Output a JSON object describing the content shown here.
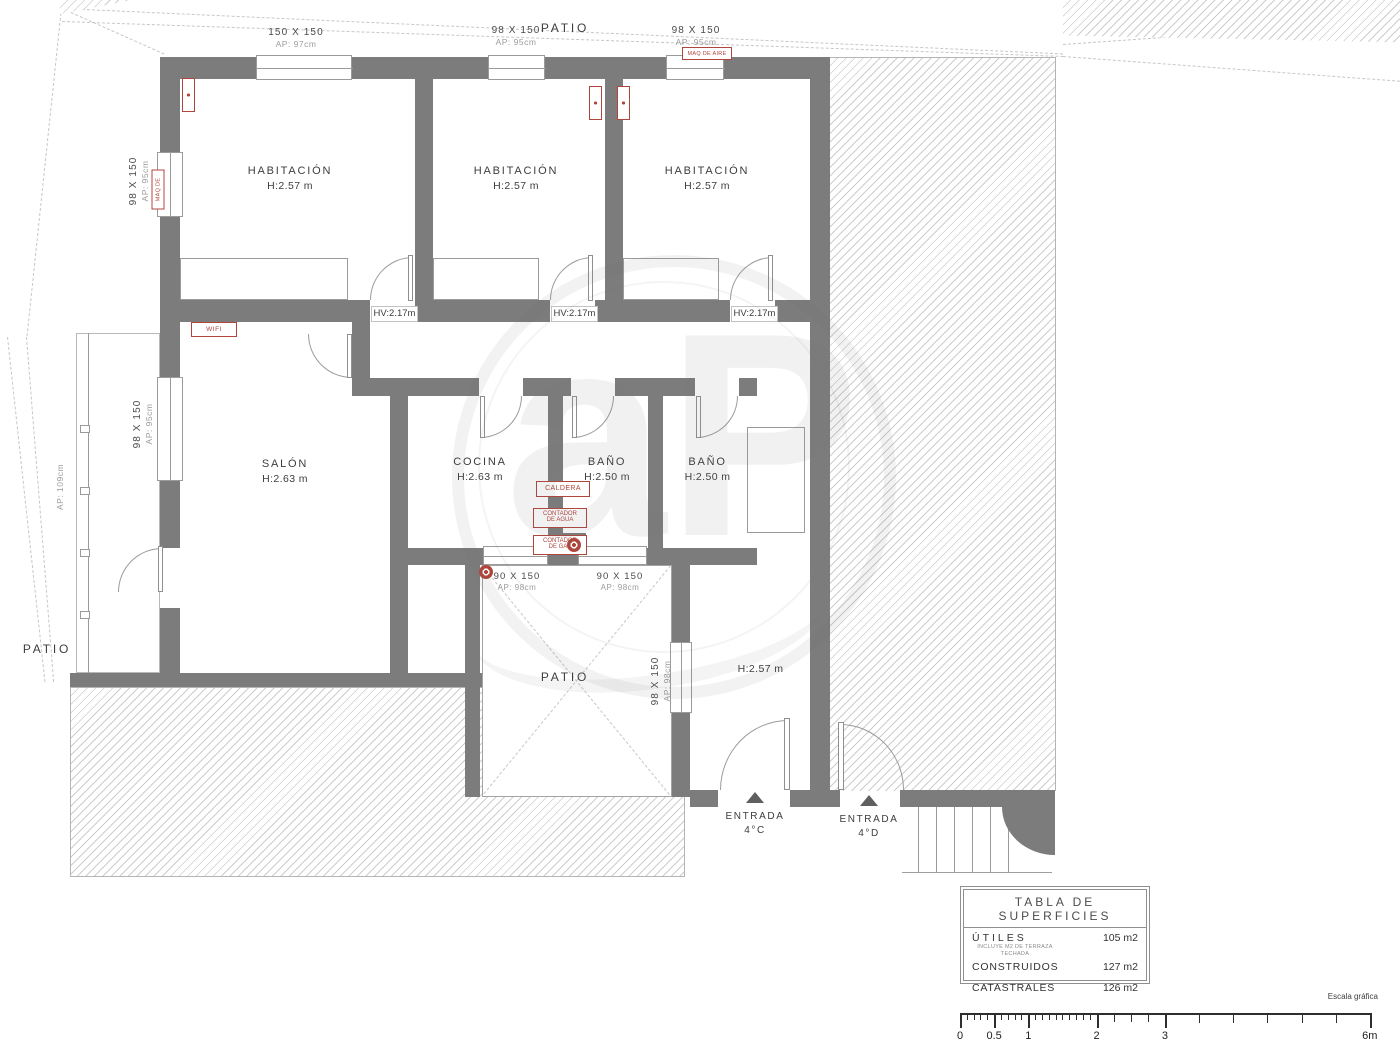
{
  "plan": {
    "watermark_text": "aP",
    "labels": {
      "patio_top": "PATIO",
      "patio_left": "PATIO",
      "patio_court": "PATIO",
      "hv": "HV:2.17m",
      "hall_h": "H:2.57 m"
    },
    "rooms": {
      "hab1_name": "HABITACIÓN",
      "hab1_h": "H:2.57 m",
      "hab2_name": "HABITACIÓN",
      "hab2_h": "H:2.57 m",
      "hab3_name": "HABITACIÓN",
      "hab3_h": "H:2.57 m",
      "salon_name": "SALÓN",
      "salon_h": "H:2.63 m",
      "cocina_name": "COCINA",
      "cocina_h": "H:2.63 m",
      "bano1_name": "BAÑO",
      "bano1_h": "H:2.50 m",
      "bano2_name": "BAÑO",
      "bano2_h": "H:2.50 m"
    },
    "windows": {
      "top1_size": "150 X 150",
      "top1_ap": "AP: 97cm",
      "top2_size": "98 X 150",
      "top2_ap": "AP: 95cm",
      "top3_size": "98 X 150",
      "top3_ap": "AP: 95cm",
      "left1_size": "98 X 150",
      "left1_ap": "AP: 95cm",
      "left2_size": "98 X 150",
      "left2_ap": "AP: 95cm",
      "terrace_ap": "AP: 109cm",
      "patio1_size": "90 X 150",
      "patio1_ap": "AP: 98cm",
      "patio2_size": "90 X 150",
      "patio2_ap": "AP: 98cm",
      "patio3_size": "98 X 150",
      "patio3_ap": "AP: 98cm"
    },
    "red": {
      "maq_top": "MAQ DE AIRE",
      "maq_left": "MAQ DE AIRE",
      "wifi": "WIFI",
      "caldera": "CALDERA",
      "cont_agua_1": "CONTADOR",
      "cont_agua_2": "DE AGUA",
      "cont_gas_1": "CONTADOR",
      "cont_gas_2": "DE GAS"
    },
    "entrances": {
      "c1": "ENTRADA",
      "c2": "4°C",
      "d1": "ENTRADA",
      "d2": "4°D"
    }
  },
  "table": {
    "title": "TABLA DE SUPERFICIES",
    "rows": [
      {
        "label": "ÚTILES",
        "note": "INCLUYE M2 DE TERRAZA TECHADA",
        "value": "105 m2"
      },
      {
        "label": "CONSTRUIDOS",
        "note": "",
        "value": "127 m2"
      },
      {
        "label": "CATASTRALES",
        "note": "",
        "value": "126 m2"
      }
    ]
  },
  "scalebar": {
    "title": "Escala gráfica",
    "unit_px_per_m": 68.3,
    "marks": [
      {
        "m": 0,
        "label": "0"
      },
      {
        "m": 0.5,
        "label": "0.5"
      },
      {
        "m": 1,
        "label": "1"
      },
      {
        "m": 2,
        "label": "2"
      },
      {
        "m": 3,
        "label": "3"
      },
      {
        "m": 6,
        "label": "6m"
      }
    ],
    "minor_segments": [
      {
        "from": 0,
        "to": 2,
        "step": 0.1,
        "h": 7
      },
      {
        "from": 2,
        "to": 3,
        "step": 0.25,
        "h": 9
      },
      {
        "from": 3,
        "to": 6,
        "step": 0.5,
        "h": 10
      }
    ]
  },
  "colors": {
    "wall": "#7c7c7c",
    "accent_red": "#b0453c"
  }
}
